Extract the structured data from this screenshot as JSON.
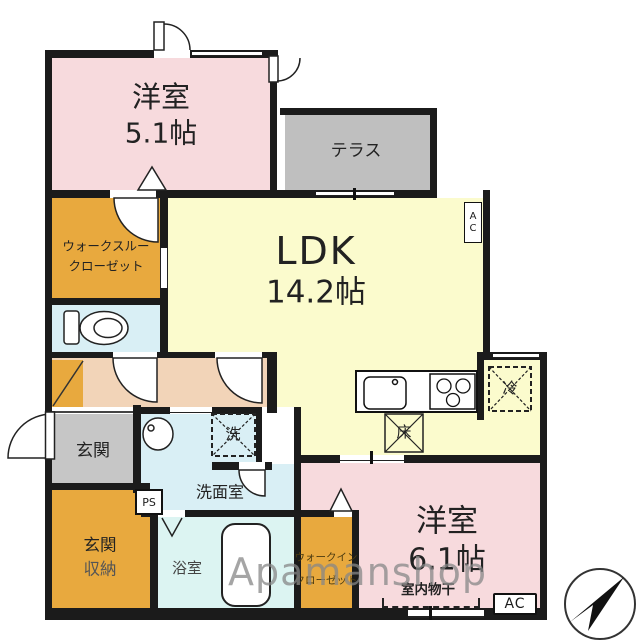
{
  "plan": {
    "rooms": {
      "bedroom1": {
        "name": "洋室",
        "size": "5.1帖"
      },
      "terrace": {
        "name": "テラス"
      },
      "ldk": {
        "name": "LDK",
        "size": "14.2帖"
      },
      "walkthrough_closet": {
        "line1": "ウォークスルー",
        "line2": "クローゼット"
      },
      "entrance": {
        "name": "玄関"
      },
      "washroom": {
        "name": "洗面室"
      },
      "entrance_storage": {
        "line1": "玄関",
        "line2": "収納"
      },
      "bathroom": {
        "name": "浴室"
      },
      "walkin_closet": {
        "line1": "ウォークイン",
        "line2": "クローゼット"
      },
      "bedroom2": {
        "name": "洋室",
        "size": "6.1帖"
      }
    },
    "equipment": {
      "pipe_space": "PS",
      "ac_upper": "AC",
      "ac_lower": "AC",
      "washer": "洗",
      "refrigerator": "冷",
      "floor_hatch": "床",
      "indoor_drying": "室内物干"
    },
    "watermark": "Apamanshop",
    "colors": {
      "bedroom_pink": "#f7dadd",
      "ldk_yellow": "#fbfbcd",
      "closet_orange": "#e8a93e",
      "hallway_beige": "#f2d4b8",
      "terrace_gray": "#bfbfbf",
      "entrance_gray": "#c6c6c6",
      "wet_area_blue": "#d9eff5",
      "wall_black": "#1b1b1b"
    }
  }
}
